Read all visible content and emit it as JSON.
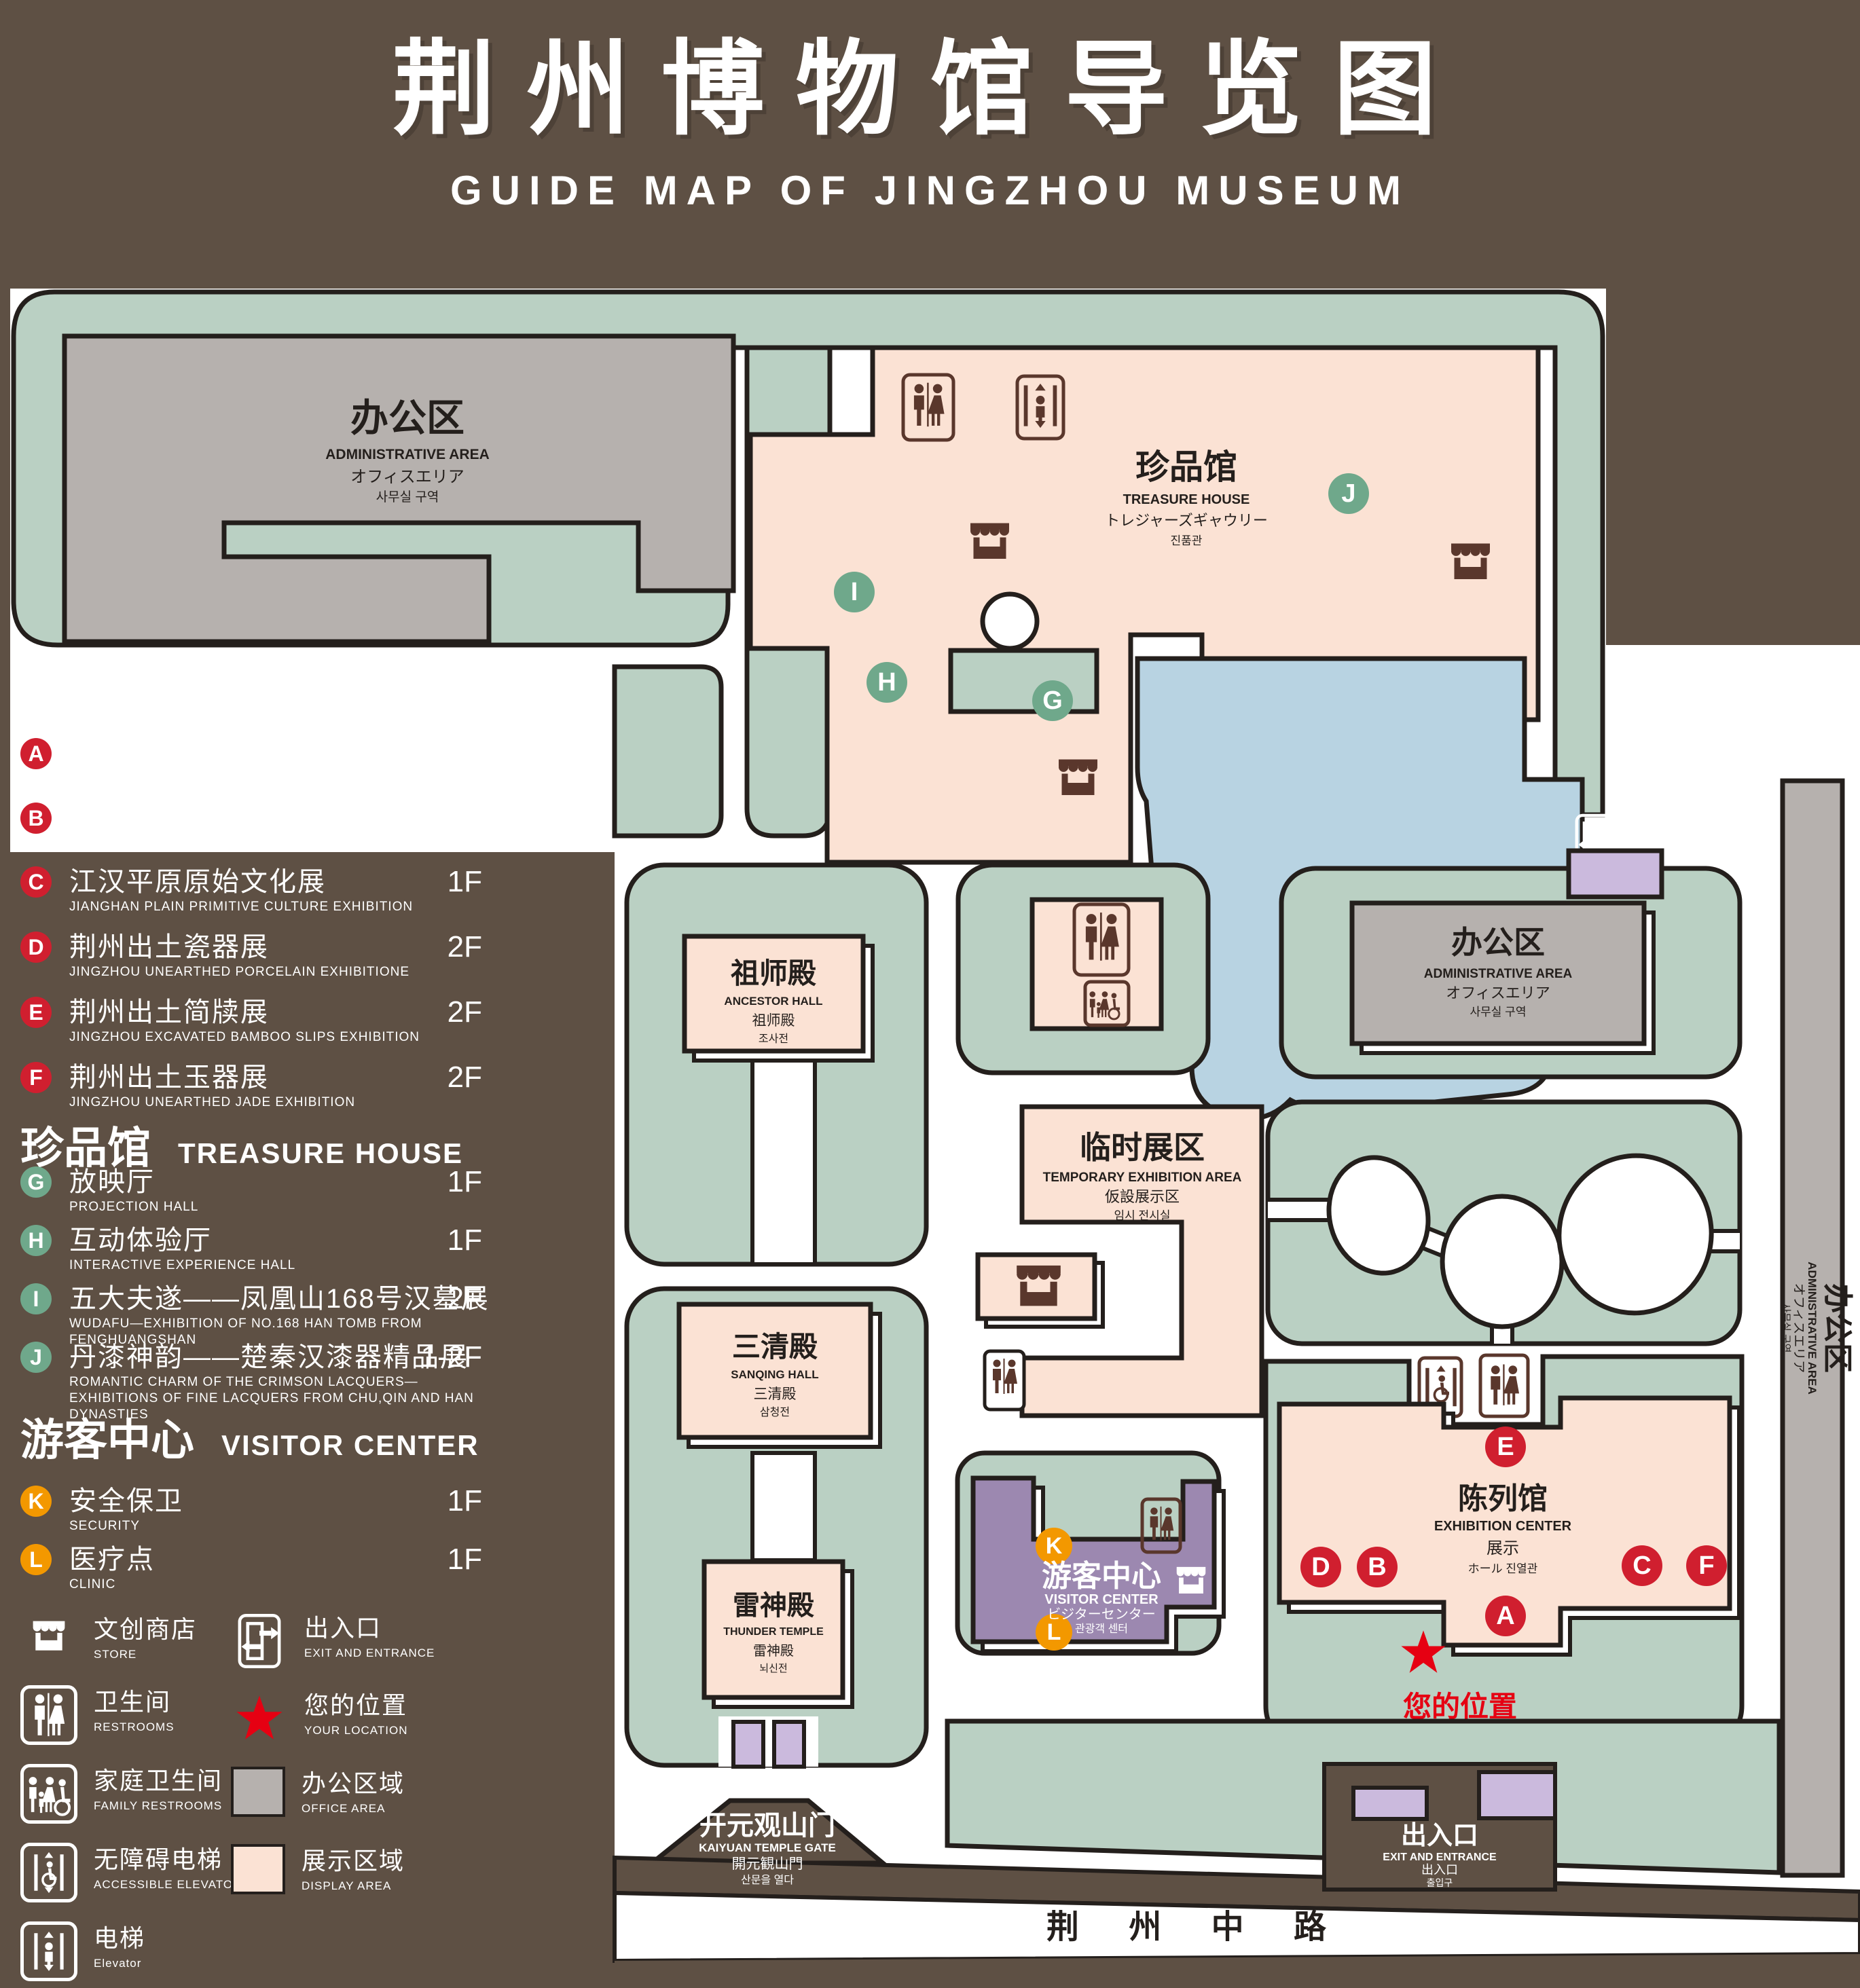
{
  "title": {
    "zh": "荆州博物馆导览图",
    "en": "GUIDE MAP OF JINGZHOU MUSEUM"
  },
  "colors": {
    "background": "#5e5044",
    "green_area": "#bad0c3",
    "display_area": "#fbe2d4",
    "office_area": "#b6b1ae",
    "pond_blue": "#b8d3e2",
    "visitor_purple": "#9c88b0",
    "pillar_lavender": "#cbbadd",
    "badge_red": "#d01f2f",
    "badge_green": "#6fa88b",
    "badge_orange": "#f39800",
    "star_red": "#e60012",
    "outline": "#241f1c"
  },
  "legend": {
    "sections": [
      {
        "title_zh": "陈列馆",
        "title_en": "EXHIBITION CENTER",
        "items": [
          {
            "letter": "A",
            "zh": "《火中的凤凰》壁画",
            "en": "THE PHOENIX IN FIRE \"MURAL PAINTING",
            "floor": "1F"
          },
          {
            "letter": "B",
            "zh": "荆州出土铜器展",
            "en": "JINGZHOU UNEARTHED BRONZE WARE EXHIBITION",
            "floor": "1F"
          },
          {
            "letter": "C",
            "zh": "江汉平原原始文化展",
            "en": "JIANGHAN PLAIN PRIMITIVE CULTURE EXHIBITION",
            "floor": "1F"
          },
          {
            "letter": "D",
            "zh": "荆州出土瓷器展",
            "en": "JINGZHOU UNEARTHED PORCELAIN EXHIBITIONE",
            "floor": "2F"
          },
          {
            "letter": "E",
            "zh": "荆州出土简牍展",
            "en": "JINGZHOU EXCAVATED BAMBOO SLIPS EXHIBITION",
            "floor": "2F"
          },
          {
            "letter": "F",
            "zh": "荆州出土玉器展",
            "en": "JINGZHOU UNEARTHED JADE EXHIBITION",
            "floor": "2F"
          }
        ]
      },
      {
        "title_zh": "珍品馆",
        "title_en": "TREASURE HOUSE",
        "items": [
          {
            "letter": "G",
            "zh": "放映厅",
            "en": "PROJECTION HALL",
            "floor": "1F"
          },
          {
            "letter": "H",
            "zh": "互动体验厅",
            "en": "INTERACTIVE EXPERIENCE HALL",
            "floor": "1F"
          },
          {
            "letter": "I",
            "zh": "五大夫遂——凤凰山168号汉墓展",
            "en": "WUDAFU—EXHIBITION OF NO.168 HAN TOMB FROM FENGHUANGSHAN",
            "floor": "2F"
          },
          {
            "letter": "J",
            "zh": "丹漆神韵——楚秦汉漆器精品展",
            "en": "ROMANTIC CHARM OF THE CRIMSON LACQUERS—EXHIBITIONS OF FINE LACQUERS FROM CHU,QIN AND HAN DYNASTIES",
            "floor": "1-2F"
          }
        ]
      },
      {
        "title_zh": "游客中心",
        "title_en": "VISITOR CENTER",
        "items": [
          {
            "letter": "K",
            "zh": "安全保卫",
            "en": "SECURITY",
            "floor": "1F"
          },
          {
            "letter": "L",
            "zh": "医疗点",
            "en": "CLINIC",
            "floor": "1F"
          }
        ]
      }
    ],
    "symbols_left": [
      {
        "zh": "文创商店",
        "en": "STORE"
      },
      {
        "zh": "卫生间",
        "en": "RESTROOMS"
      },
      {
        "zh": "家庭卫生间",
        "en": "FAMILY RESTROOMS"
      },
      {
        "zh": "无障碍电梯",
        "en": "ACCESSIBLE ELEVATOR"
      },
      {
        "zh": "电梯",
        "en": "Elevator"
      }
    ],
    "symbols_right": [
      {
        "zh": "出入口",
        "en": "EXIT AND ENTRANCE"
      },
      {
        "zh": "您的位置",
        "en": "YOUR LOCATION"
      },
      {
        "zh": "办公区域",
        "en": "OFFICE AREA"
      },
      {
        "zh": "展示区域",
        "en": "DISPLAY AREA"
      }
    ]
  },
  "map": {
    "admin": {
      "zh": "办公区",
      "en": "ADMINISTRATIVE AREA",
      "ja": "オフィスエリア",
      "ko": "사무실 구역"
    },
    "treasure": {
      "zh": "珍品馆",
      "en": "TREASURE HOUSE",
      "ja": "トレジャーズギャウリー",
      "ko": "진품관"
    },
    "ancestor": {
      "zh": "祖师殿",
      "en": "ANCESTOR HALL",
      "ja": "祖师殿",
      "ko": "조사전"
    },
    "sanqing": {
      "zh": "三清殿",
      "en": "SANQING HALL",
      "ja": "三清殿",
      "ko": "삼청전"
    },
    "thunder": {
      "zh": "雷神殿",
      "en": "THUNDER TEMPLE",
      "ja": "雷神殿",
      "ko": "뇌신전"
    },
    "temporary": {
      "zh": "临时展区",
      "en": "TEMPORARY EXHIBITION AREA",
      "ja": "仮設展示区",
      "ko": "임시 전시실"
    },
    "exhibition": {
      "zh": "陈列馆",
      "en": "EXHIBITION CENTER",
      "line3": "展示",
      "line4": "ホール 진열관"
    },
    "visitor": {
      "zh": "游客中心",
      "en": "VISITOR CENTER",
      "ja": "ビジターセンター",
      "ko": "관광객 센터"
    },
    "gate": {
      "zh": "开元观山门",
      "en": "KAIYUAN TEMPLE GATE",
      "ja": "開元観山門",
      "ko": "산문을 열다"
    },
    "exit": {
      "zh": "出入口",
      "en": "EXIT AND ENTRANCE",
      "ja": "出入口",
      "ko": "출입구"
    },
    "road": "荆 州 中 路",
    "your_location": "您的位置"
  }
}
